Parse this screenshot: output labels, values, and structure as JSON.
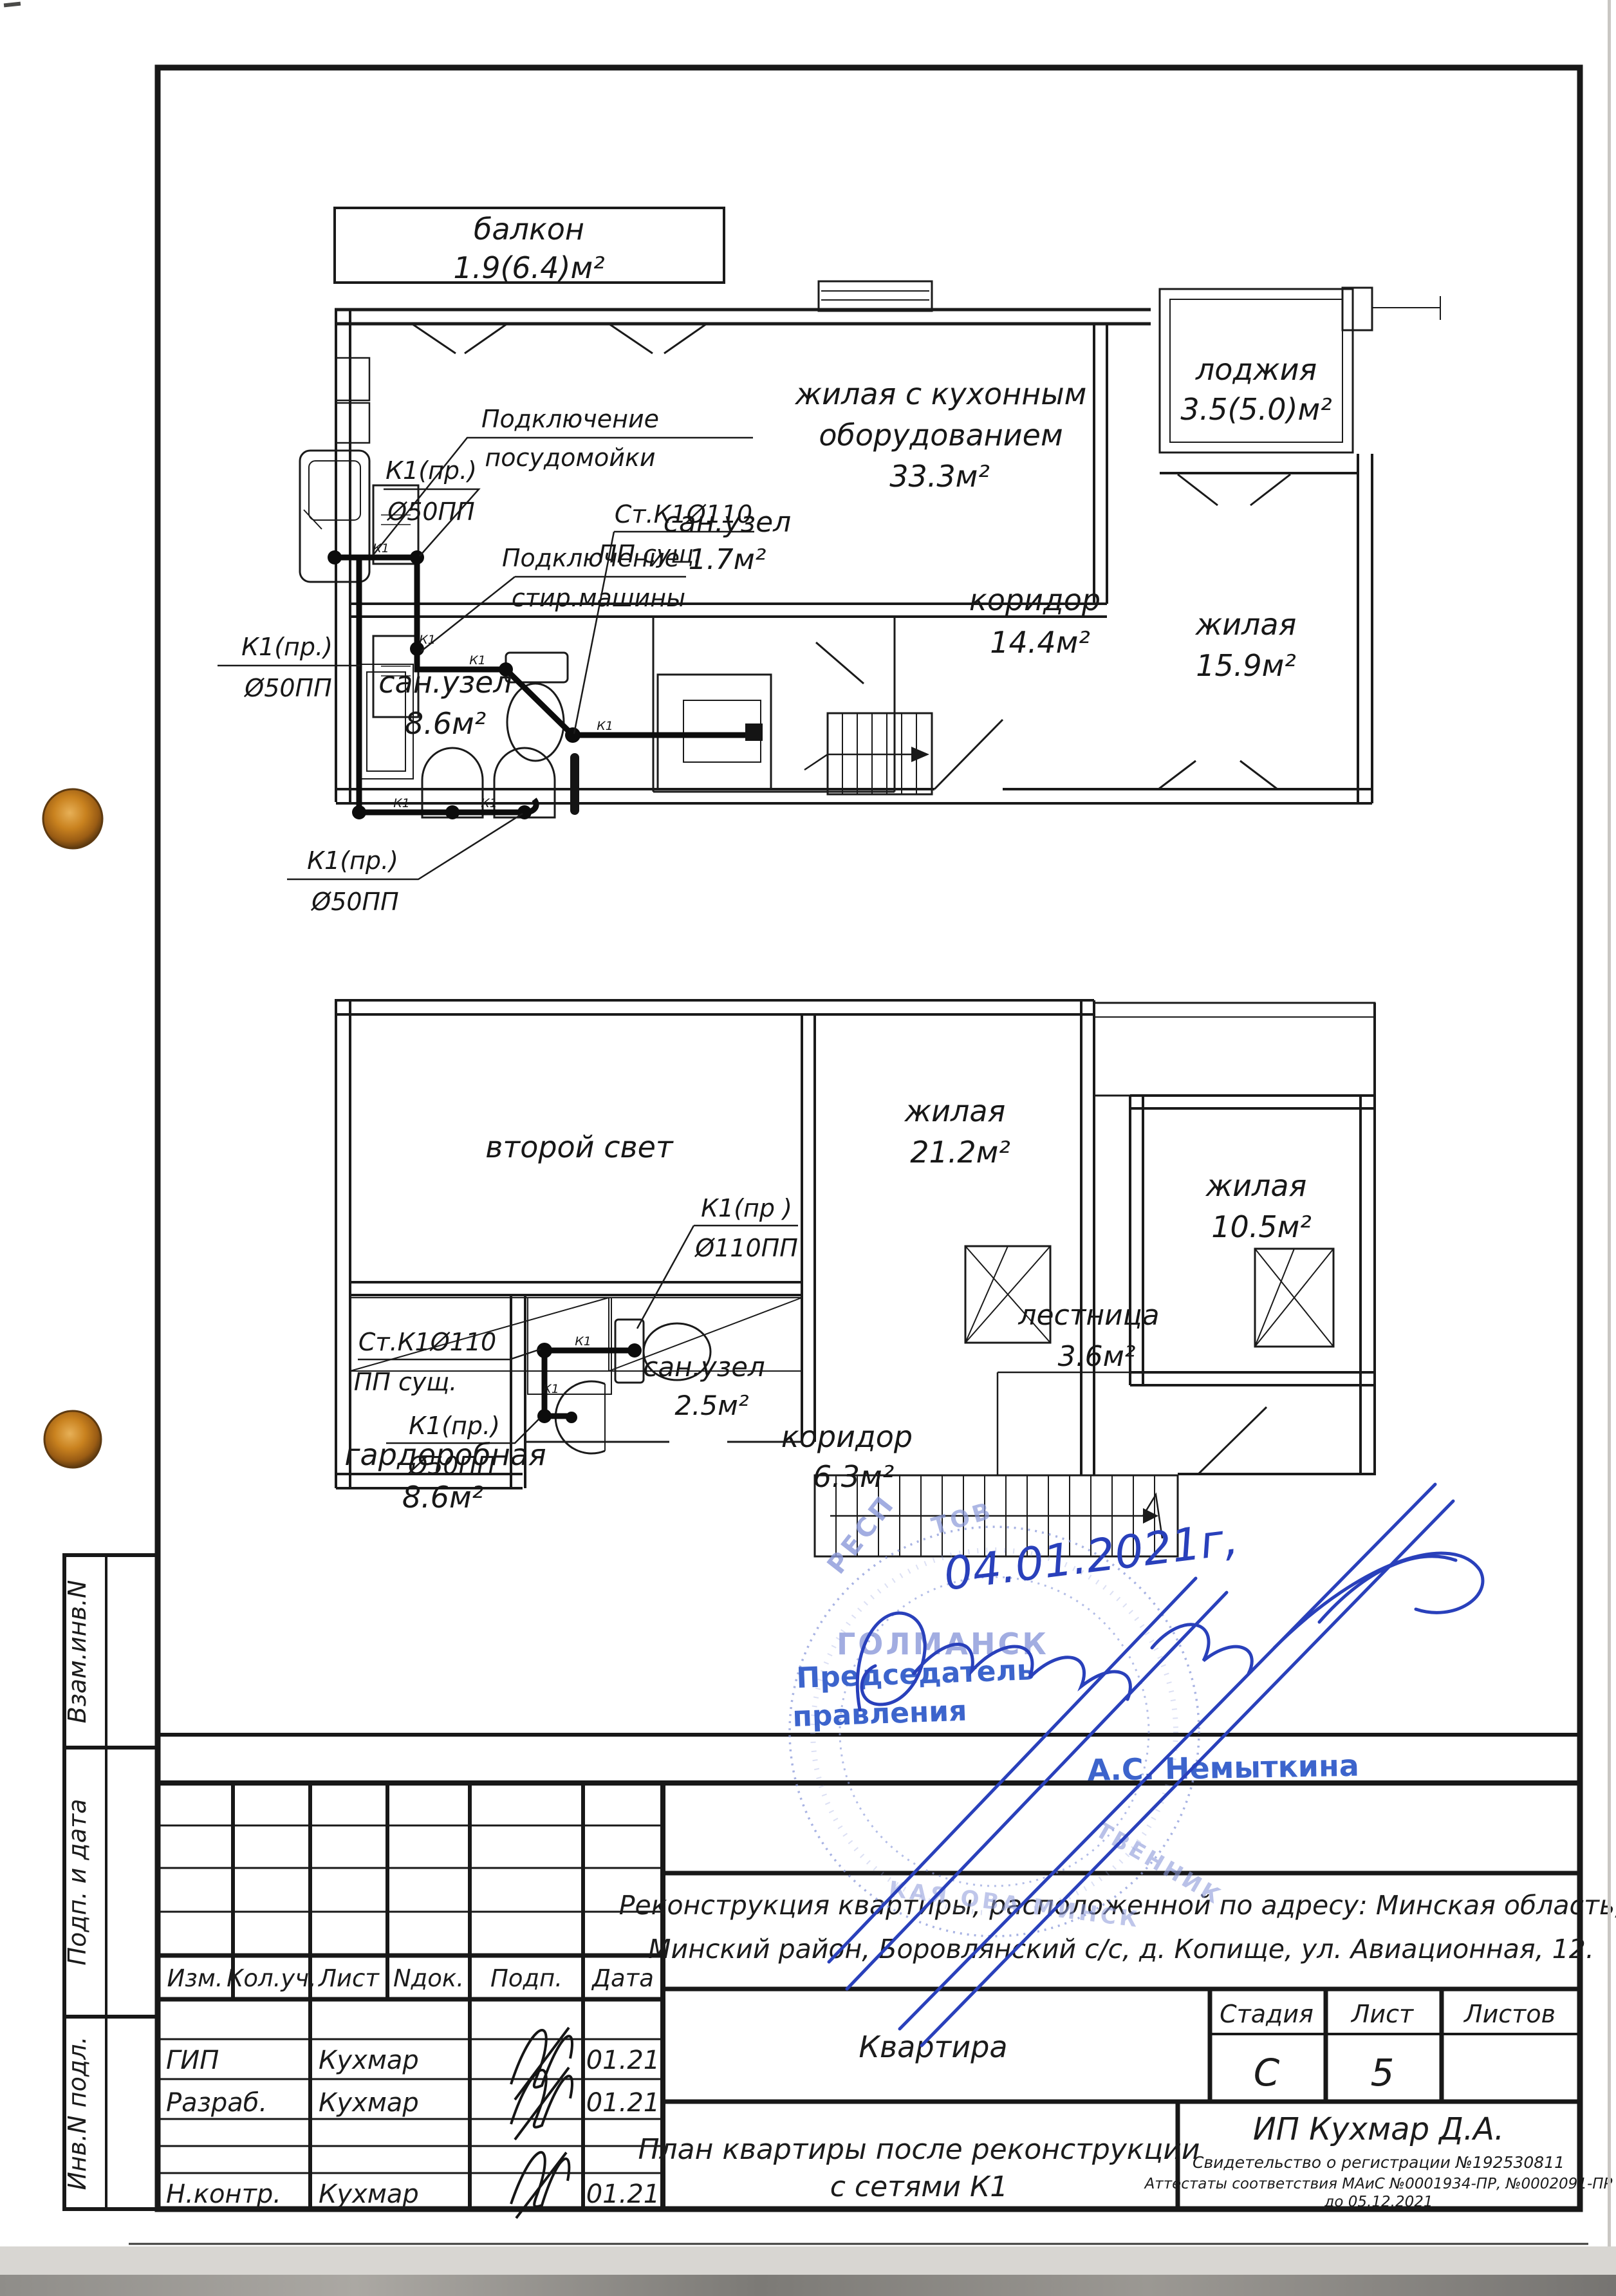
{
  "upper_plan": {
    "rooms": [
      {
        "name": "балкон",
        "area": "1.9(6.4)м²"
      },
      {
        "name": "жилая с кухонным",
        "name2": "оборудованием",
        "area": "33.3м²"
      },
      {
        "name": "лоджия",
        "area": "3.5(5.0)м²"
      },
      {
        "name": "сан.узел",
        "area": "1.7м²"
      },
      {
        "name": "коридор",
        "area": "14.4м²"
      },
      {
        "name": "жилая",
        "area": "15.9м²"
      },
      {
        "name": "сан.узел",
        "area": "8.6м²"
      }
    ],
    "annotations": [
      {
        "line1": "Подключение",
        "line2": "посудомойки"
      },
      {
        "line1": "К1(пр.)",
        "line2": "Ø50ПП"
      },
      {
        "line1": "Ст.К1Ø110",
        "line2": "ПП сущ."
      },
      {
        "line1": "Подключение",
        "line2": "стир.машины"
      },
      {
        "line1": "К1(пр.)",
        "line2": "Ø50ПП"
      },
      {
        "line1": "К1(пр.)",
        "line2": "Ø50ПП"
      }
    ],
    "pipe_tick": "К1"
  },
  "lower_plan": {
    "rooms": [
      {
        "name": "второй свет",
        "area": ""
      },
      {
        "name": "жилая",
        "area": "21.2м²"
      },
      {
        "name": "жилая",
        "area": "10.5м²"
      },
      {
        "name": "лестница",
        "area": "3.6м²"
      },
      {
        "name": "сан.узел",
        "area": "2.5м²"
      },
      {
        "name": "коридор",
        "area": "6.3м²"
      },
      {
        "name": "гардеробная",
        "area": "8.6м²"
      }
    ],
    "annotations": [
      {
        "line1": "К1(пр )",
        "line2": "Ø110ПП"
      },
      {
        "line1": "Ст.К1Ø110",
        "line2": "ПП сущ."
      },
      {
        "line1": "К1(пр.)",
        "line2": "Ø50ПП"
      }
    ]
  },
  "approval": {
    "date": "04.01.2021г,",
    "role_line1": "Председатель",
    "role_line2": "правления",
    "name": "А.С. Немыткина",
    "stamp_center": "ГОЛМАНСК",
    "stamp_rim1": "РЕСП",
    "stamp_rim2": "ТОВ",
    "stamp_rim3": "ТВЕННИК",
    "stamp_rim4": "КАЯ ОВА МИНСК"
  },
  "title_block": {
    "address_line1": "Реконструкция квартиры, расположенной по адресу: Минская область,",
    "address_line2": "Минский район, Боровлянский с/с, д. Копище, ул. Авиационная, 12.",
    "object": "Квартира",
    "stage_label": "Стадия",
    "sheet_label": "Лист",
    "sheets_label": "Листов",
    "stage": "С",
    "sheet": "5",
    "sheets": "",
    "drawing_title_line1": "План квартиры после реконструкции",
    "drawing_title_line2": "с сетями К1",
    "company": "ИП Кухмар Д.А.",
    "certificate": "Свидетельство о регистрации  №192530811",
    "attestation": "Аттестаты соответствия МАиС  №0001934-ПР, №0002091-ПР",
    "attestation2": "до  05.12.2021",
    "header": {
      "izm": "Изм.",
      "kol": "Кол.уч.",
      "list": "Лист",
      "ndok": "Nдок.",
      "podp": "Подп.",
      "data": "Дата"
    },
    "rows": [
      {
        "role": "ГИП",
        "name": "Кухмар",
        "date": "01.21"
      },
      {
        "role": "Разраб.",
        "name": "Кухмар",
        "date": "01.21"
      },
      {
        "role": "Н.контр.",
        "name": "Кухмар",
        "date": "01.21"
      }
    ]
  },
  "side_strip": {
    "f1": "Взам.инв.N",
    "f2": "Подп. и дата",
    "f3": "Инв.N подл."
  }
}
